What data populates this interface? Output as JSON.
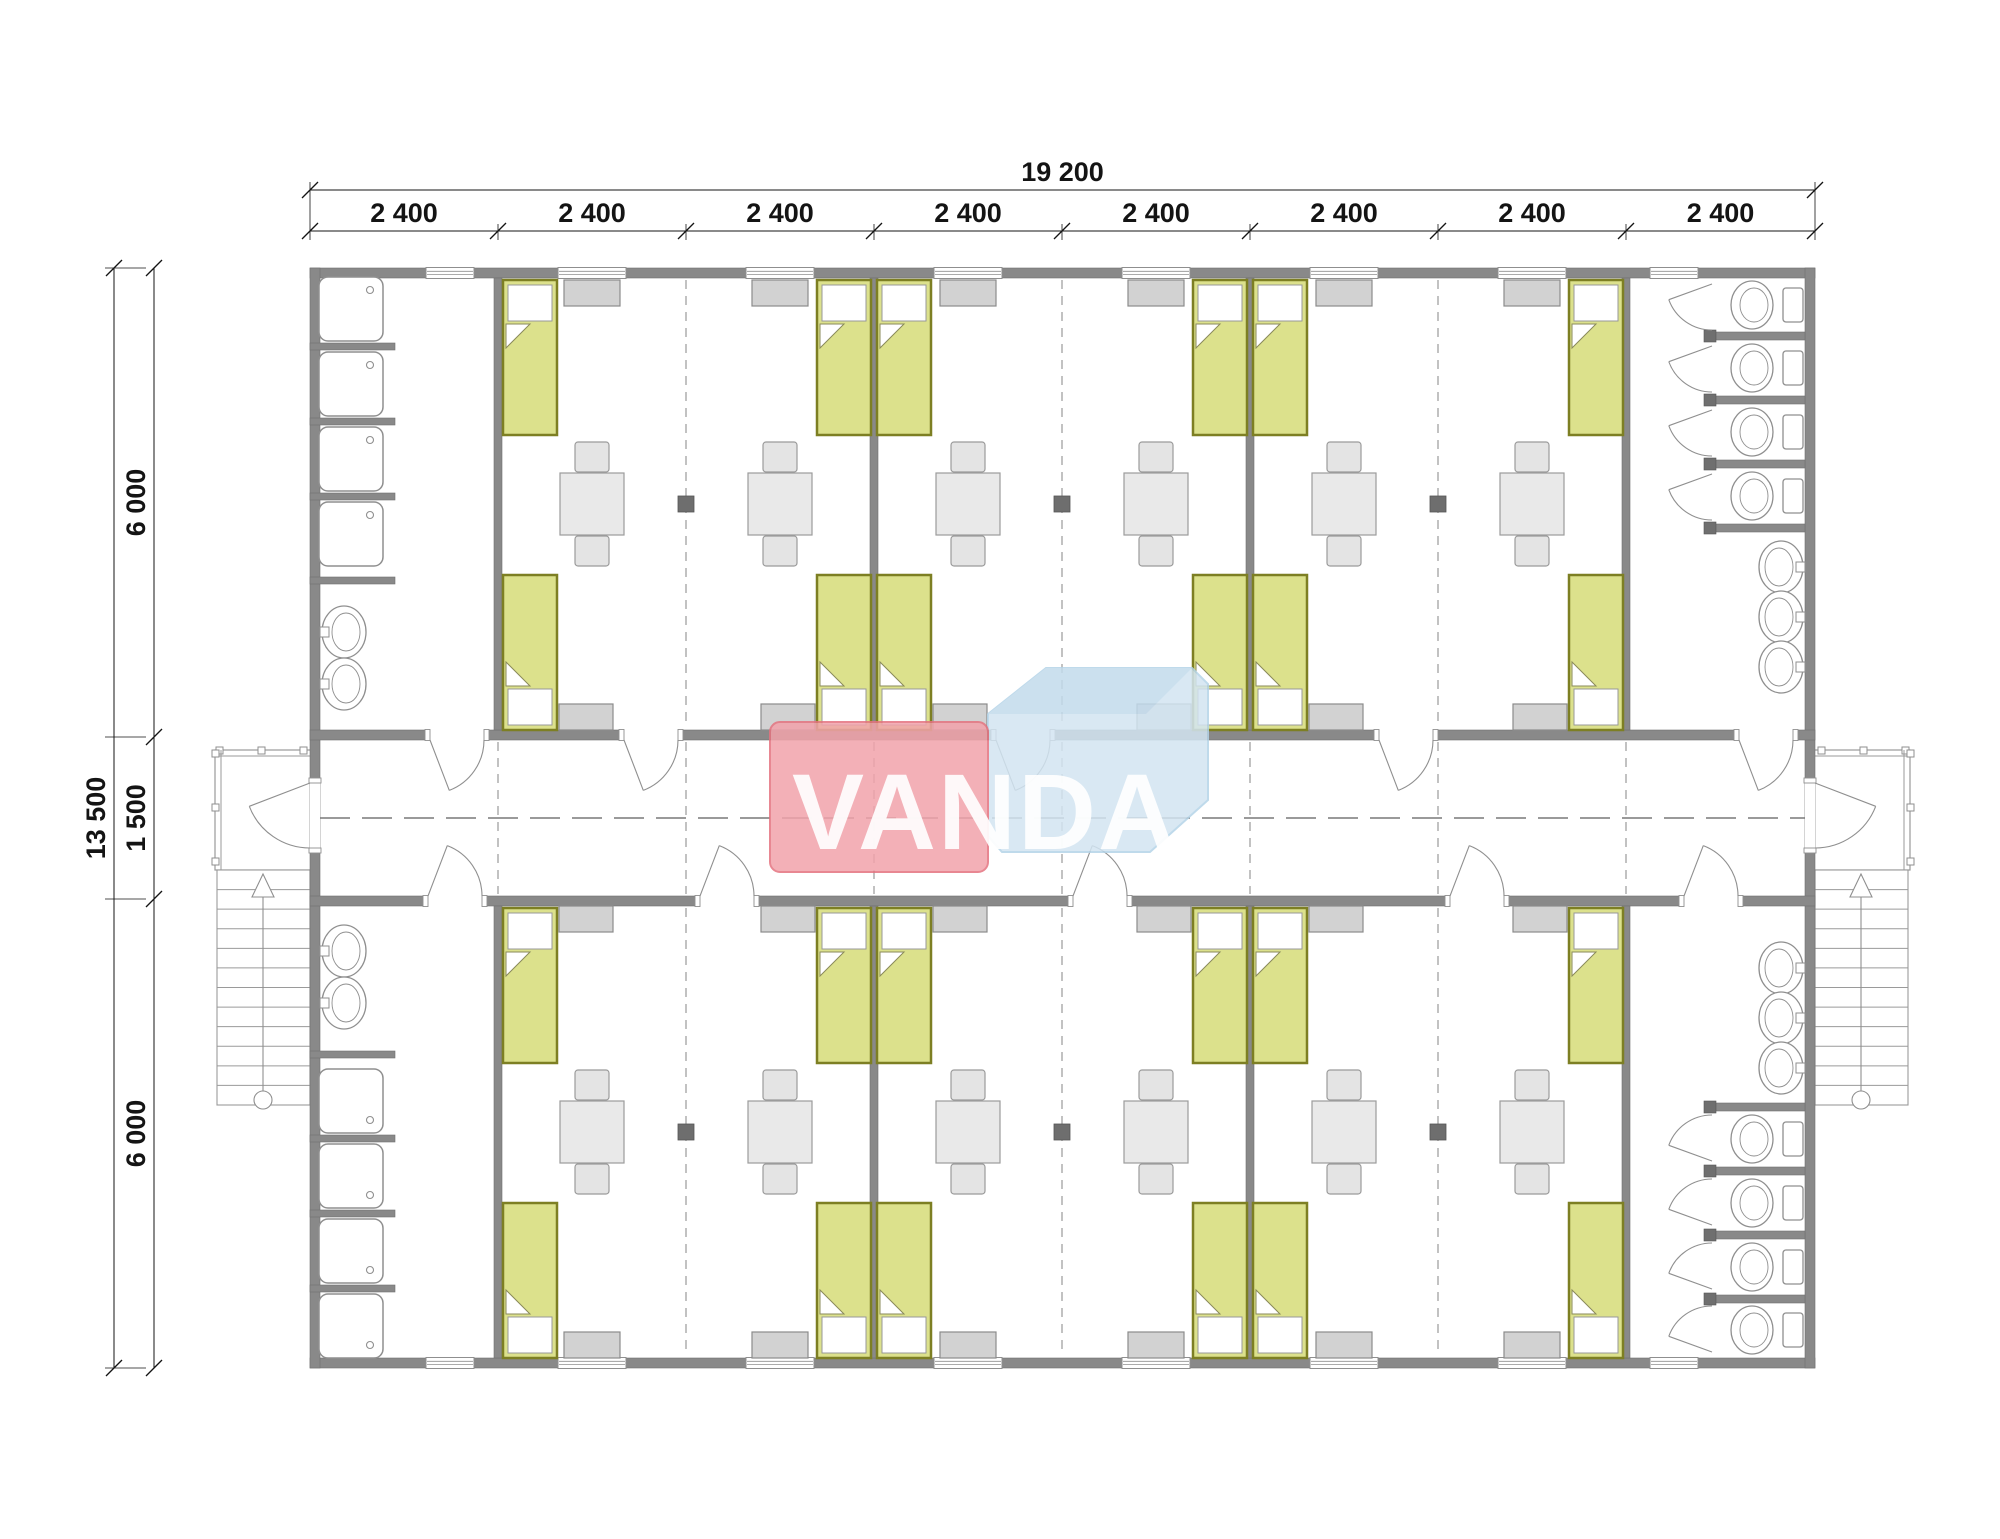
{
  "canvas": {
    "width": 2000,
    "height": 1539,
    "background": "#ffffff"
  },
  "palette": {
    "wall": "#898989",
    "wall_dark": "#6f6f6f",
    "line": "#8f8f8f",
    "thin": "#9a9a9a",
    "dash": "#9a9a9a",
    "center_dash": "#787878",
    "bed_fill": "#dce18c",
    "bed_border": "#7d7f23",
    "pillow": "#ffffff",
    "wardrobe_fill": "#d2d2d2",
    "wardrobe_border": "#8b8b8b",
    "furniture_fill": "#e9e9e9",
    "furniture_border": "#9b9b9b",
    "column": "#6e6e6e",
    "dim_color": "#141414",
    "wm_pink": "#f2a3ab",
    "wm_pink_edge": "#e5737f",
    "wm_blue": "#d3e5f2",
    "wm_blue_facet": "#c3dbec",
    "wm_blue_edge": "#b5d4e8",
    "wm_text_color": "#ffffff"
  },
  "dimensions": {
    "top": {
      "total": "19 200",
      "segments": [
        "2 400",
        "2 400",
        "2 400",
        "2 400",
        "2 400",
        "2 400",
        "2 400",
        "2 400"
      ]
    },
    "left": {
      "total": "13 500",
      "segments": [
        "6 000",
        "1 500",
        "6 000"
      ]
    }
  },
  "watermark": {
    "text": "VANDA"
  },
  "plan": {
    "building": {
      "x1": 310,
      "y1": 268,
      "x2": 1815,
      "y2": 1368,
      "wall": 10
    },
    "corridor": {
      "top_wall_y": 730,
      "bottom_wall_y": 896,
      "wall": 10,
      "center_y": 818
    },
    "module_x": [
      310,
      498,
      686,
      874,
      1062,
      1250,
      1438,
      1626,
      1815
    ],
    "divider_wall_x": [
      494,
      870,
      1246,
      1622
    ],
    "dashed_room_x": [
      686,
      1062,
      1438
    ],
    "dashed_corridor_x": [
      498,
      686,
      874,
      1062,
      1250,
      1438,
      1626
    ],
    "columns": {
      "x": [
        686,
        1062,
        1438
      ],
      "y": [
        496,
        1124
      ],
      "size": 16
    },
    "windows": [
      {
        "x": 426,
        "w": 48
      },
      {
        "x": 558,
        "w": 68
      },
      {
        "x": 746,
        "w": 68
      },
      {
        "x": 934,
        "w": 68
      },
      {
        "x": 1122,
        "w": 68
      },
      {
        "x": 1310,
        "w": 68
      },
      {
        "x": 1498,
        "w": 68
      },
      {
        "x": 1650,
        "w": 48
      }
    ],
    "beds": {
      "w": 54,
      "h": 155,
      "cols": [
        503,
        817,
        877,
        1193,
        1253,
        1569
      ],
      "rows": [
        {
          "y": 280,
          "pillow": "start"
        },
        {
          "y": 575,
          "pillow": "end"
        },
        {
          "y": 908,
          "pillow": "start"
        },
        {
          "y": 1203,
          "pillow": "end"
        }
      ]
    },
    "tables": {
      "cx": [
        592,
        780,
        968,
        1156,
        1344,
        1532
      ],
      "cy": [
        504,
        1132
      ]
    },
    "wardrobes_outer": {
      "x": [
        564,
        752,
        940,
        1128,
        1316,
        1504
      ],
      "w": 56,
      "h": 26,
      "y": [
        280,
        1332
      ]
    },
    "wardrobes_corridor": {
      "x": [
        559,
        761,
        933,
        1137,
        1309,
        1513
      ],
      "w": 54,
      "h": 26,
      "y": [
        704,
        906
      ]
    },
    "doors_top_wall": {
      "x": [
        430,
        624,
        996,
        1379,
        1739
      ],
      "w": 54
    },
    "doors_bottom_wall": {
      "x": [
        428,
        700,
        1073,
        1450,
        1684
      ],
      "w": 54
    },
    "entry_doors": {
      "y": 783,
      "h": 65
    },
    "sanitary": {
      "showers": {
        "x": 319,
        "size": 64,
        "top_y": [
          277,
          352,
          427,
          502
        ],
        "bottom_y": [
          1069,
          1144,
          1219,
          1294
        ]
      },
      "partitions": {
        "x1": 310,
        "x2": 395,
        "h": 7,
        "top_y": [
          343,
          418,
          493,
          577
        ],
        "bottom_y": [
          1051,
          1135,
          1210,
          1285
        ]
      },
      "sinks_cy": {
        "top": [
          632,
          684
        ],
        "bottom": [
          951,
          1003
        ]
      }
    },
    "wc": {
      "stall_x1": 1712,
      "stall_x2": 1805,
      "partition_h": 8,
      "partitions_top": [
        332,
        396,
        460,
        524
      ],
      "partitions_bottom": [
        1103,
        1167,
        1231,
        1295
      ],
      "stall_tops_top": [
        278,
        340,
        404,
        468
      ],
      "stall_bottoms_bottom": [
        1167,
        1231,
        1295,
        1358
      ],
      "toilets_cy_top": [
        305,
        368,
        432,
        496
      ],
      "toilets_cy_bottom": [
        1139,
        1203,
        1267,
        1330
      ],
      "sinks_cy_top": [
        567,
        617,
        667
      ],
      "sinks_cy_bottom": [
        968,
        1018,
        1068
      ]
    },
    "porches": {
      "left": {
        "landing": [
          215,
          750,
          97,
          120
        ],
        "stairs": [
          217,
          870,
          93,
          235
        ],
        "center_x": 263,
        "rail_posts_top_x": [
          216,
          258,
          300
        ],
        "rail_posts_side_y": [
          750,
          804,
          858
        ]
      },
      "right": {
        "landing": [
          1813,
          750,
          97,
          120
        ],
        "stairs": [
          1815,
          870,
          93,
          235
        ],
        "center_x": 1861,
        "rail_posts_top_x": [
          1818,
          1860,
          1902
        ],
        "rail_posts_side_y": [
          750,
          804,
          858
        ]
      },
      "treads": 12,
      "circle_r": 9
    },
    "dims_layout": {
      "top_line1_y": 190,
      "top_line2_y": 231,
      "left_line1_x": 114,
      "left_line2_x": 154,
      "left_ticks_y": [
        268,
        737,
        899,
        1368
      ]
    },
    "watermark_geo": {
      "pink": [
        770,
        722,
        218,
        150
      ],
      "blue_body": "988,714 1046,668 1192,668 1208,684 1208,800 1150,852 1002,852 988,836",
      "blue_facet": "988,714 1046,668 1192,668 1146,714",
      "text_x": 985,
      "text_y": 849
    }
  }
}
